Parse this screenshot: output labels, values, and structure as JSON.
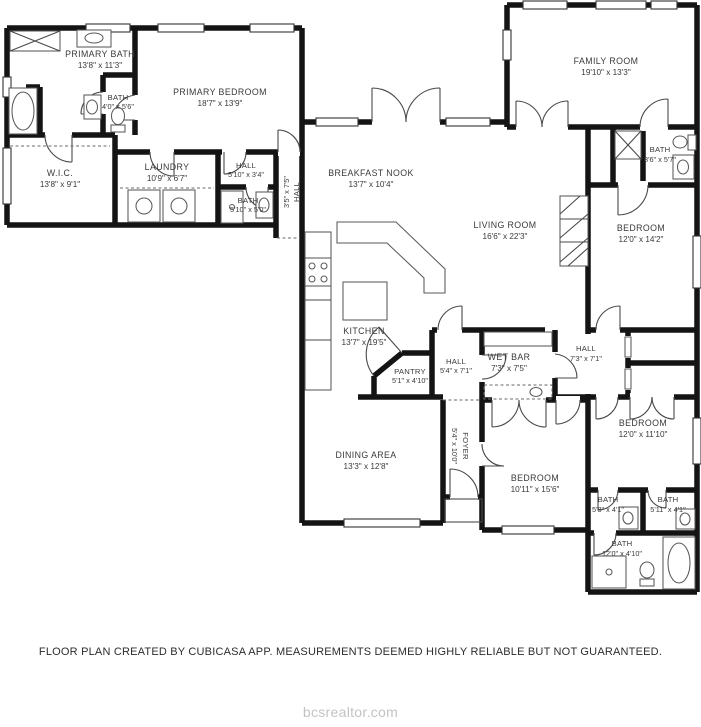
{
  "footer": {
    "disclaimer": "FLOOR PLAN CREATED BY CUBICASA APP. MEASUREMENTS DEEMED HIGHLY RELIABLE BUT NOT GUARANTEED.",
    "watermark": "bcsrealtor.com"
  },
  "colors": {
    "wall": "#141414",
    "label": "#3a3a3a",
    "watermark": "#c3c3c3",
    "background": "#ffffff"
  },
  "rooms": [
    {
      "id": "primary-bath",
      "name": "PRIMARY BATH",
      "dims": "13'8\" x 11'3\""
    },
    {
      "id": "bath-2",
      "name": "BATH",
      "dims": "4'0\" x 5'6\""
    },
    {
      "id": "primary-bedroom",
      "name": "PRIMARY BEDROOM",
      "dims": "18'7\" x 13'9\""
    },
    {
      "id": "wic",
      "name": "W.I.C.",
      "dims": "13'8\" x 9'1\""
    },
    {
      "id": "laundry",
      "name": "LAUNDRY",
      "dims": "10'9\" x 6'7\""
    },
    {
      "id": "hall-1",
      "name": "HALL",
      "dims": "5'10\" x 3'4\""
    },
    {
      "id": "bath-3",
      "name": "BATH",
      "dims": "5'10\" x 5'0\""
    },
    {
      "id": "hall-2",
      "name": "HALL",
      "dims": "3'5\" x 7'5\""
    },
    {
      "id": "breakfast-nook",
      "name": "BREAKFAST NOOK",
      "dims": "13'7\" x 10'4\""
    },
    {
      "id": "family-room",
      "name": "FAMILY ROOM",
      "dims": "19'10\" x 13'3\""
    },
    {
      "id": "living-room",
      "name": "LIVING ROOM",
      "dims": "16'6\" x 22'3\""
    },
    {
      "id": "bath-4",
      "name": "BATH",
      "dims": "8'6\" x 5'7\""
    },
    {
      "id": "bedroom-1",
      "name": "BEDROOM",
      "dims": "12'0\" x 14'2\""
    },
    {
      "id": "kitchen",
      "name": "KITCHEN",
      "dims": "13'7\" x 19'5\""
    },
    {
      "id": "pantry",
      "name": "PANTRY",
      "dims": "5'1\" x 4'10\""
    },
    {
      "id": "hall-3",
      "name": "HALL",
      "dims": "5'4\" x 7'1\""
    },
    {
      "id": "wet-bar",
      "name": "WET BAR",
      "dims": "7'3\" x 7'5\""
    },
    {
      "id": "hall-4",
      "name": "HALL",
      "dims": "7'3\" x 7'1\""
    },
    {
      "id": "dining-area",
      "name": "DINING AREA",
      "dims": "13'3\" x 12'8\""
    },
    {
      "id": "foyer",
      "name": "FOYER",
      "dims": "5'4\" x 10'0\""
    },
    {
      "id": "bedroom-2",
      "name": "BEDROOM",
      "dims": "10'11\" x 15'6\""
    },
    {
      "id": "bedroom-3",
      "name": "BEDROOM",
      "dims": "12'0\" x 11'10\""
    },
    {
      "id": "bath-5",
      "name": "BATH",
      "dims": "5'8\" x 4'1\""
    },
    {
      "id": "bath-6",
      "name": "BATH",
      "dims": "5'11\" x 4'1\""
    },
    {
      "id": "bath-7",
      "name": "BATH",
      "dims": "12'0\" x 4'10\""
    }
  ]
}
